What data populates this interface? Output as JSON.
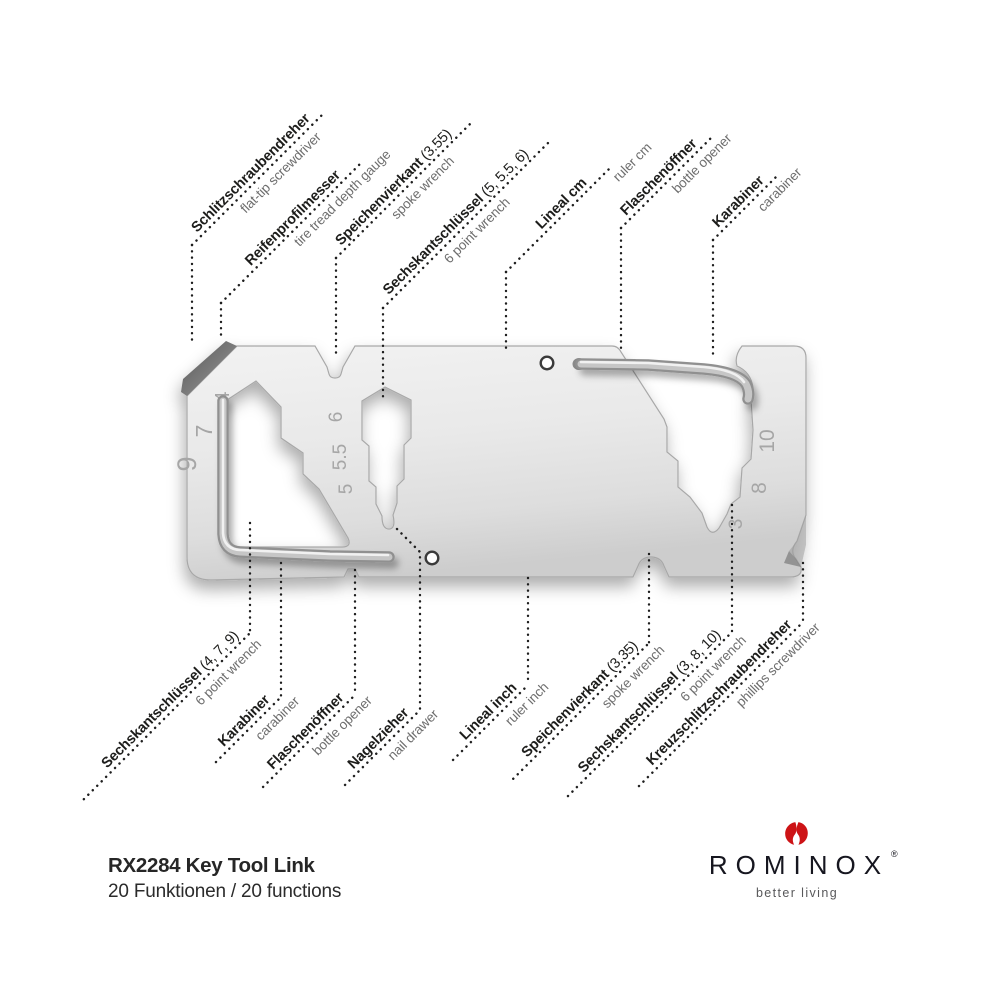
{
  "footer": {
    "model": "RX2284 Key Tool Link",
    "functions": "20 Funktionen / 20 functions"
  },
  "brand": {
    "name": "ROMINOX",
    "registered": "®",
    "tagline": "better living",
    "logo_red": "#cd1316"
  },
  "labels": {
    "top": [
      {
        "de": "Schlitzschraubendreher",
        "suffix": "",
        "en": "flat-tip screwdriver"
      },
      {
        "de": "Reifenprofilmesser",
        "suffix": "",
        "en": "tire tread depth gauge"
      },
      {
        "de": "Speichenvierkant",
        "suffix": " (3.55)",
        "en": "spoke wrench"
      },
      {
        "de": "Sechskantschlüssel",
        "suffix": " (5, 5.5, 6)",
        "en": "6 point wrench"
      },
      {
        "de": "Lineal cm",
        "suffix": "",
        "en": "ruler cm"
      },
      {
        "de": "Flaschenöffner",
        "suffix": "",
        "en": "bottle opener"
      },
      {
        "de": "Karabiner",
        "suffix": "",
        "en": "carabiner"
      }
    ],
    "bottom": [
      {
        "de": "Sechskantschlüssel",
        "suffix": " (4, 7, 9)",
        "en": "6 point wrench"
      },
      {
        "de": "Karabiner",
        "suffix": "",
        "en": "carabiner"
      },
      {
        "de": "Flaschenöffner",
        "suffix": "",
        "en": "bottle opener"
      },
      {
        "de": "Nagelzieher",
        "suffix": "",
        "en": "nail drawer"
      },
      {
        "de": "Lineal inch",
        "suffix": "",
        "en": "ruler inch"
      },
      {
        "de": "Speichenvierkant",
        "suffix": " (3.35)",
        "en": "spoke wrench"
      },
      {
        "de": "Sechskantschlüssel",
        "suffix": " (3, 8, 10)",
        "en": "6 point wrench"
      },
      {
        "de": "Kreuzschlitzschraubendreher",
        "suffix": "",
        "en": "phillips screwdriver"
      }
    ]
  },
  "engravings": {
    "left": [
      "4",
      "7",
      "9"
    ],
    "middle": [
      "6",
      "5.5",
      "5"
    ],
    "right": [
      "10",
      "8",
      "3"
    ]
  },
  "colors": {
    "label_dark": "#1d1d1b",
    "label_gray": "#6e6e6e",
    "metal_light": "#f0f0f0",
    "metal_dark": "#cfcfcf",
    "accent_red": "#cd1316"
  }
}
